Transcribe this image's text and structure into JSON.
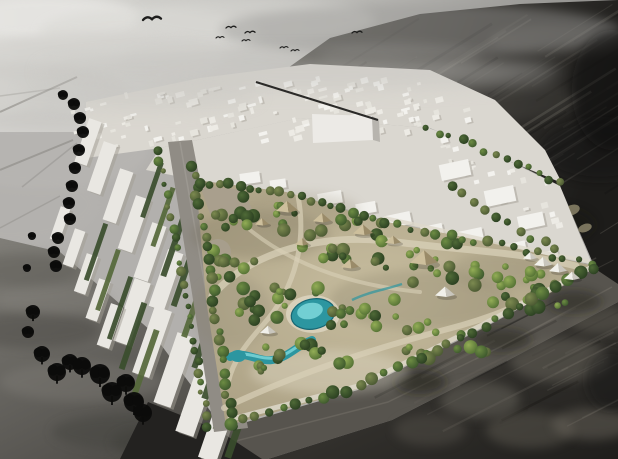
{
  "image": {
    "width": 618,
    "height": 459,
    "alt": "Aerial architectural rendering: a green rectangular central-park masterplan with lagoon and canopy structures set inside a white city massing model, surrounded by dark monochrome existing urban fabric, birds flying in a gray sky"
  },
  "palette": {
    "terrain": "#b2b0ad",
    "terrain_road": "#7e7b76",
    "white_city": "#dad7d0",
    "building_shadow": "#a19d94",
    "box_front": "#eceae6",
    "box_side": "#b7b4ae",
    "road_gray": "#908c85",
    "median": "#a8a49d",
    "road_band": "#57544e",
    "lane": "#716e66",
    "asphalt_black": "#232220",
    "park_edge_path": "#ddd8ca",
    "path_light": "#d8d0b8",
    "plaza": "#a89f8e",
    "water": "#2c96a0",
    "water_light": "#85dde0",
    "water_deep": "#176673",
    "water_deck": "#e9e3d2",
    "canopy_light": "#cdbf9c",
    "canopy_dark": "#9a8b69",
    "tent_light": "#f1f0ea",
    "tent_dark": "#c9c6bd",
    "hedge": "#3a4d2c",
    "hedge_light": "#55683a",
    "slab_white": "#e9e7e2",
    "khaki": "#8b8468",
    "black_tree": "#0c0c0b",
    "bird": "#1d1d1c",
    "diag_line": "#2b2a28",
    "haze": "#c6c5c1"
  },
  "scene": {
    "clouds": [
      [
        50,
        18,
        90,
        22,
        "#e6e5e2",
        0.9
      ],
      [
        150,
        32,
        110,
        24,
        "#dcdbd7",
        0.7
      ],
      [
        255,
        20,
        120,
        22,
        "#d6d5d1",
        0.55
      ],
      [
        95,
        58,
        130,
        26,
        "#d0cfcb",
        0.55
      ],
      [
        20,
        95,
        110,
        32,
        "#c6c5c1",
        0.45
      ],
      [
        40,
        150,
        110,
        40,
        "#bfbdba",
        0.35
      ],
      [
        10,
        205,
        90,
        40,
        "#b7b5b1",
        0.3
      ],
      [
        210,
        60,
        90,
        20,
        "#cccbc7",
        0.4
      ]
    ],
    "terrain_roads": [
      [
        0,
        112,
        77,
        77,
        2,
        0.5
      ],
      [
        0,
        170,
        73,
        140,
        2,
        0.45
      ],
      [
        22,
        187,
        77,
        143,
        1.5,
        0.3
      ],
      [
        0,
        96,
        60,
        88,
        1.5,
        0.25
      ],
      [
        0,
        228,
        60,
        196,
        1.5,
        0.3
      ],
      [
        0,
        255,
        52,
        286,
        2,
        0.25
      ]
    ],
    "ll_bands": [
      [
        30,
        330,
        70,
        18,
        "#4e4c47",
        0.5
      ],
      [
        82,
        382,
        82,
        20,
        "#8a8781",
        0.3
      ],
      [
        132,
        432,
        80,
        18,
        "#454440",
        0.5
      ],
      [
        55,
        300,
        60,
        14,
        "#8d8a84",
        0.3
      ],
      [
        172,
        442,
        60,
        16,
        "#3d3c38",
        0.45
      ],
      [
        20,
        270,
        60,
        16,
        "#55534e",
        0.35
      ]
    ],
    "upper_mottles": [
      [
        400,
        58,
        80,
        18,
        "#8f8d88",
        0.16
      ],
      [
        480,
        100,
        100,
        22,
        "#8a8880",
        0.12
      ],
      [
        560,
        40,
        70,
        16,
        "#94928c",
        0.2
      ],
      [
        360,
        140,
        60,
        14,
        "#807e76",
        0.12
      ],
      [
        600,
        150,
        60,
        30,
        "#151412",
        0.5
      ],
      [
        545,
        225,
        50,
        20,
        "#14130f",
        0.35
      ],
      [
        420,
        30,
        200,
        26,
        "#9a9996",
        0.45
      ],
      [
        612,
        90,
        40,
        60,
        "#111110",
        0.5
      ]
    ],
    "lower_mottles": [
      [
        480,
        400,
        40,
        18,
        "#6b675e",
        0.5
      ],
      [
        560,
        360,
        50,
        22,
        "#716d63",
        0.45
      ],
      [
        600,
        320,
        30,
        14,
        "#6e6a60",
        0.4
      ],
      [
        430,
        430,
        36,
        16,
        "#645f56",
        0.35
      ],
      [
        530,
        430,
        44,
        18,
        "#6a665c",
        0.4
      ],
      [
        592,
        424,
        40,
        16,
        "#716c62",
        0.45
      ],
      [
        462,
        352,
        30,
        12,
        "#5e5a51",
        0.3
      ],
      [
        420,
        382,
        26,
        12,
        "#131210",
        0.5
      ],
      [
        502,
        340,
        30,
        12,
        "#14130f",
        0.4
      ],
      [
        574,
        302,
        28,
        12,
        "#161511",
        0.4
      ],
      [
        610,
        380,
        24,
        30,
        "#181713",
        0.45
      ]
    ],
    "park_shade": [
      [
        260,
        235,
        70,
        24,
        "#6f6753",
        0.25
      ],
      [
        420,
        300,
        90,
        30,
        "#6a6450",
        0.2
      ],
      [
        330,
        372,
        80,
        22,
        "#f1ecdc",
        0.3
      ],
      [
        232,
        312,
        40,
        36,
        "#8d8572",
        0.25
      ],
      [
        500,
        270,
        50,
        18,
        "#746e5a",
        0.18
      ],
      [
        300,
        210,
        60,
        18,
        "#8f8670",
        0.2
      ]
    ],
    "streak_sets": [
      {
        "o": [
          320,
          34
        ],
        "u": [
          290,
          -22
        ],
        "v": [
          86,
          176
        ],
        "n": 30,
        "ang": -32,
        "lmin": 60,
        "lmax": 220,
        "wmin": 1,
        "wmax": 2.6,
        "omin": 0.08,
        "omax": 0.26,
        "c": "#8a877c"
      },
      {
        "o": [
          330,
          40
        ],
        "u": [
          280,
          -20
        ],
        "v": [
          80,
          170
        ],
        "n": 16,
        "ang": -32,
        "lmin": 40,
        "lmax": 160,
        "wmin": 1,
        "wmax": 3,
        "omin": 0.12,
        "omax": 0.3,
        "c": "#121110"
      },
      {
        "o": [
          388,
          296
        ],
        "u": [
          212,
          -52
        ],
        "v": [
          66,
          146
        ],
        "n": 22,
        "ang": -27,
        "lmin": 40,
        "lmax": 150,
        "wmin": 1,
        "wmax": 2.4,
        "omin": 0.1,
        "omax": 0.3,
        "c": "#7d7970"
      },
      {
        "o": [
          380,
          300
        ],
        "u": [
          210,
          -50
        ],
        "v": [
          64,
          140
        ],
        "n": 12,
        "ang": -27,
        "lmin": 30,
        "lmax": 110,
        "wmin": 1,
        "wmax": 2.6,
        "omin": 0.12,
        "omax": 0.3,
        "c": "#100f0d"
      }
    ],
    "khaki_structures": [
      [
        468,
        152,
        7,
        4
      ],
      [
        488,
        162,
        8,
        4
      ],
      [
        510,
        173,
        8,
        4
      ],
      [
        532,
        182,
        7,
        4
      ],
      [
        552,
        194,
        8,
        5
      ],
      [
        572,
        210,
        8,
        5
      ],
      [
        585,
        228,
        7,
        4
      ],
      [
        478,
        132,
        6,
        3
      ],
      [
        500,
        145,
        6,
        3
      ],
      [
        525,
        158,
        6,
        3
      ],
      [
        455,
        205,
        9,
        5
      ],
      [
        478,
        218,
        8,
        4
      ],
      [
        540,
        240,
        8,
        4
      ],
      [
        562,
        252,
        7,
        4
      ]
    ],
    "block_zones": [
      {
        "o": [
          95,
          95
        ],
        "u": [
          330,
          -26
        ],
        "v": [
          24,
          56
        ],
        "n": 85,
        "smin": 3,
        "smax": 9,
        "rot": -15
      },
      {
        "o": [
          300,
          74
        ],
        "u": [
          150,
          8
        ],
        "v": [
          30,
          58
        ],
        "n": 28,
        "smin": 3,
        "smax": 8,
        "rot": -15
      },
      {
        "o": [
          436,
          136
        ],
        "u": [
          110,
          44
        ],
        "v": [
          24,
          58
        ],
        "n": 24,
        "smin": 3,
        "smax": 8,
        "rot": -14
      },
      {
        "o": [
          62,
          108
        ],
        "u": [
          60,
          -8
        ],
        "v": [
          16,
          44
        ],
        "n": 14,
        "smin": 3,
        "smax": 7,
        "rot": -15
      }
    ],
    "parcels": [
      [
        250,
        178,
        20,
        11,
        -8
      ],
      [
        278,
        184,
        16,
        9,
        -8
      ],
      [
        330,
        198,
        24,
        12,
        -10
      ],
      [
        366,
        208,
        20,
        11,
        -10
      ],
      [
        398,
        220,
        26,
        13,
        -12
      ],
      [
        432,
        231,
        22,
        12,
        -12
      ],
      [
        470,
        236,
        26,
        13,
        -12
      ],
      [
        515,
        248,
        22,
        11,
        -12
      ],
      [
        549,
        256,
        18,
        10,
        -12
      ],
      [
        455,
        170,
        30,
        16,
        -12
      ],
      [
        500,
        196,
        30,
        16,
        -12
      ],
      [
        531,
        221,
        26,
        14,
        -12
      ]
    ],
    "slabs": [
      [
        88,
        142,
        46,
        13
      ],
      [
        102,
        168,
        52,
        14
      ],
      [
        118,
        196,
        54,
        14
      ],
      [
        134,
        224,
        56,
        15
      ],
      [
        150,
        252,
        58,
        15
      ],
      [
        166,
        280,
        60,
        16
      ],
      [
        132,
        312,
        66,
        17
      ],
      [
        152,
        342,
        70,
        18
      ],
      [
        174,
        370,
        74,
        18
      ],
      [
        197,
        397,
        78,
        19
      ],
      [
        220,
        422,
        80,
        19
      ],
      [
        74,
        248,
        38,
        11
      ],
      [
        86,
        274,
        40,
        12
      ],
      [
        98,
        300,
        42,
        12
      ],
      [
        110,
        326,
        44,
        13
      ],
      [
        60,
        224,
        34,
        10
      ]
    ],
    "slab_angle": -71,
    "hedges": [
      [
        152,
        190,
        58,
        5
      ],
      [
        163,
        217,
        62,
        5
      ],
      [
        174,
        245,
        66,
        6
      ],
      [
        185,
        273,
        70,
        6
      ],
      [
        196,
        302,
        74,
        6
      ],
      [
        207,
        331,
        78,
        6
      ],
      [
        218,
        360,
        82,
        7
      ],
      [
        230,
        389,
        86,
        7
      ],
      [
        242,
        416,
        88,
        7
      ],
      [
        96,
        252,
        60,
        5
      ],
      [
        108,
        280,
        64,
        5
      ],
      [
        120,
        308,
        66,
        5
      ],
      [
        133,
        336,
        70,
        6
      ],
      [
        145,
        364,
        72,
        6
      ]
    ],
    "tree_rows": [
      {
        "name": "boulevard-west",
        "pts": [
          [
            158,
            150
          ],
          [
            176,
            240
          ],
          [
            192,
            330
          ],
          [
            208,
            428
          ]
        ],
        "n": 26,
        "rmin": 2.5,
        "rmax": 5.5
      },
      {
        "name": "park-west-edge",
        "pts": [
          [
            192,
            165
          ],
          [
            208,
            255
          ],
          [
            220,
            345
          ],
          [
            232,
            424
          ]
        ],
        "n": 26,
        "rmin": 3,
        "rmax": 6
      },
      {
        "name": "park-north-edge",
        "pts": [
          [
            198,
            182
          ],
          [
            286,
            192
          ],
          [
            382,
            221
          ]
        ],
        "n": 19,
        "rmin": 3,
        "rmax": 5.5
      },
      {
        "name": "park-northeast-edge",
        "pts": [
          [
            386,
            223
          ],
          [
            500,
            245
          ],
          [
            590,
            264
          ]
        ],
        "n": 17,
        "rmin": 3,
        "rmax": 5.5
      },
      {
        "name": "southeast-road",
        "pts": [
          [
            230,
            424
          ],
          [
            300,
            403
          ],
          [
            358,
            388
          ],
          [
            480,
            329
          ],
          [
            592,
            267
          ]
        ],
        "n": 30,
        "rmin": 3.5,
        "rmax": 7
      },
      {
        "name": "city-dark-boundary",
        "pts": [
          [
            428,
            128
          ],
          [
            500,
            156
          ],
          [
            560,
            184
          ]
        ],
        "n": 13,
        "rmin": 2.5,
        "rmax": 5
      },
      {
        "name": "east-parcel-trees",
        "pts": [
          [
            452,
            186
          ],
          [
            520,
            230
          ],
          [
            556,
            250
          ]
        ],
        "n": 10,
        "rmin": 3,
        "rmax": 5
      }
    ],
    "park_clusters": [
      [
        250,
        215,
        46,
        22,
        16
      ],
      [
        330,
        240,
        55,
        22,
        18
      ],
      [
        430,
        260,
        60,
        24,
        18
      ],
      [
        510,
        285,
        45,
        20,
        14
      ],
      [
        280,
        300,
        50,
        24,
        16
      ],
      [
        380,
        320,
        55,
        22,
        16
      ],
      [
        300,
        360,
        55,
        20,
        16
      ],
      [
        440,
        345,
        50,
        20,
        14
      ],
      [
        232,
        262,
        24,
        30,
        10
      ],
      [
        540,
        300,
        30,
        14,
        8
      ]
    ],
    "cluster_rmin": 3,
    "cluster_rmax": 7,
    "canopies": [
      [
        287,
        207,
        11
      ],
      [
        322,
        218,
        9
      ],
      [
        363,
        230,
        10
      ],
      [
        424,
        258,
        14
      ],
      [
        350,
        264,
        9
      ],
      [
        302,
        242,
        7
      ],
      [
        393,
        240,
        8
      ],
      [
        262,
        222,
        7
      ]
    ],
    "white_tents": [
      [
        543,
        262,
        9
      ],
      [
        558,
        268,
        9
      ],
      [
        572,
        276,
        8
      ],
      [
        530,
        256,
        7
      ],
      [
        445,
        292,
        10
      ],
      [
        268,
        330,
        8
      ]
    ],
    "black_trees": [
      [
        63,
        95,
        5
      ],
      [
        74,
        104,
        6
      ],
      [
        80,
        118,
        6
      ],
      [
        83,
        132,
        6
      ],
      [
        79,
        150,
        6
      ],
      [
        75,
        168,
        6
      ],
      [
        72,
        186,
        6
      ],
      [
        69,
        203,
        6
      ],
      [
        70,
        219,
        6
      ],
      [
        58,
        238,
        6
      ],
      [
        54,
        252,
        6
      ],
      [
        56,
        266,
        6
      ],
      [
        32,
        236,
        4
      ],
      [
        27,
        268,
        4
      ],
      [
        33,
        312,
        7
      ],
      [
        28,
        332,
        6
      ],
      [
        42,
        354,
        8
      ],
      [
        57,
        372,
        9
      ],
      [
        70,
        362,
        8
      ],
      [
        82,
        366,
        9
      ],
      [
        100,
        374,
        10
      ],
      [
        112,
        392,
        10
      ],
      [
        126,
        383,
        9
      ],
      [
        134,
        402,
        10
      ],
      [
        143,
        413,
        9
      ]
    ],
    "birds": [
      [
        152,
        20,
        9
      ],
      [
        231,
        28,
        5
      ],
      [
        250,
        33,
        5
      ],
      [
        220,
        38,
        4
      ],
      [
        246,
        41,
        4
      ],
      [
        284,
        48,
        4
      ],
      [
        295,
        51,
        4
      ],
      [
        357,
        33,
        5
      ]
    ]
  }
}
